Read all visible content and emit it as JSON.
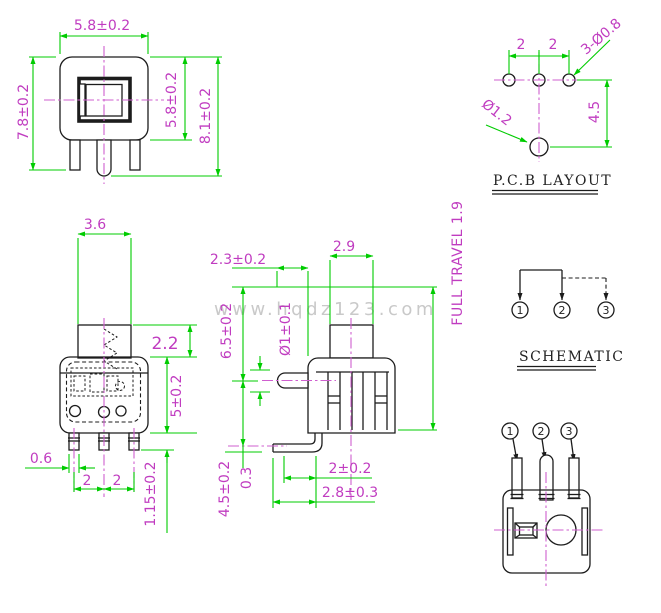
{
  "colors": {
    "dimension_green": "#00cc00",
    "annotation_magenta": "#c03cc0",
    "centerline_magenta": "#cf5fcf",
    "line_black": "#1c1c1c",
    "watermark_gray": "#c9c9c9"
  },
  "watermark": "www.hqdz123.com",
  "notes": {
    "full_travel": "FULL TRAVEL 1.9"
  },
  "front_view": {
    "dim_width": "5.8±0.2",
    "dim_total_height": "7.8±0.2",
    "dim_body_height": "5.8±0.2",
    "dim_overall_height": "8.1±0.2"
  },
  "pcb_layout": {
    "title": "P.C.B LAYOUT",
    "dim_pitch_a": "2",
    "dim_pitch_b": "2",
    "note_pin_holes": "3-Ø0.8",
    "note_center_hole": "Ø1.2",
    "dim_row_offset": "4.5"
  },
  "side_view": {
    "dim_stem_width": "3.6",
    "dim_stem_height": "2.2",
    "dim_body_height": "5±0.2",
    "dim_pin_width": "0.6",
    "dim_pin_pitch_a": "2",
    "dim_pin_pitch_b": "2",
    "dim_pin_length": "1.15±0.2"
  },
  "section_view": {
    "dim_pin_tip_offset": "2.3±0.2",
    "dim_stem_width": "2.9",
    "dim_upper_height": "6.5±0.2",
    "dim_side_pin_dia": "Ø1±0.1",
    "dim_lower_height": "4.5±0.2",
    "dim_pin_thickness": "0.3",
    "dim_bend_offset": "2±0.2",
    "dim_bend_length": "2.8±0.3"
  },
  "schematic": {
    "title": "SCHEMATIC",
    "pin_1": "1",
    "pin_2": "2",
    "pin_3": "3"
  },
  "bottom_view": {
    "pin_1": "1",
    "pin_2": "2",
    "pin_3": "3"
  }
}
